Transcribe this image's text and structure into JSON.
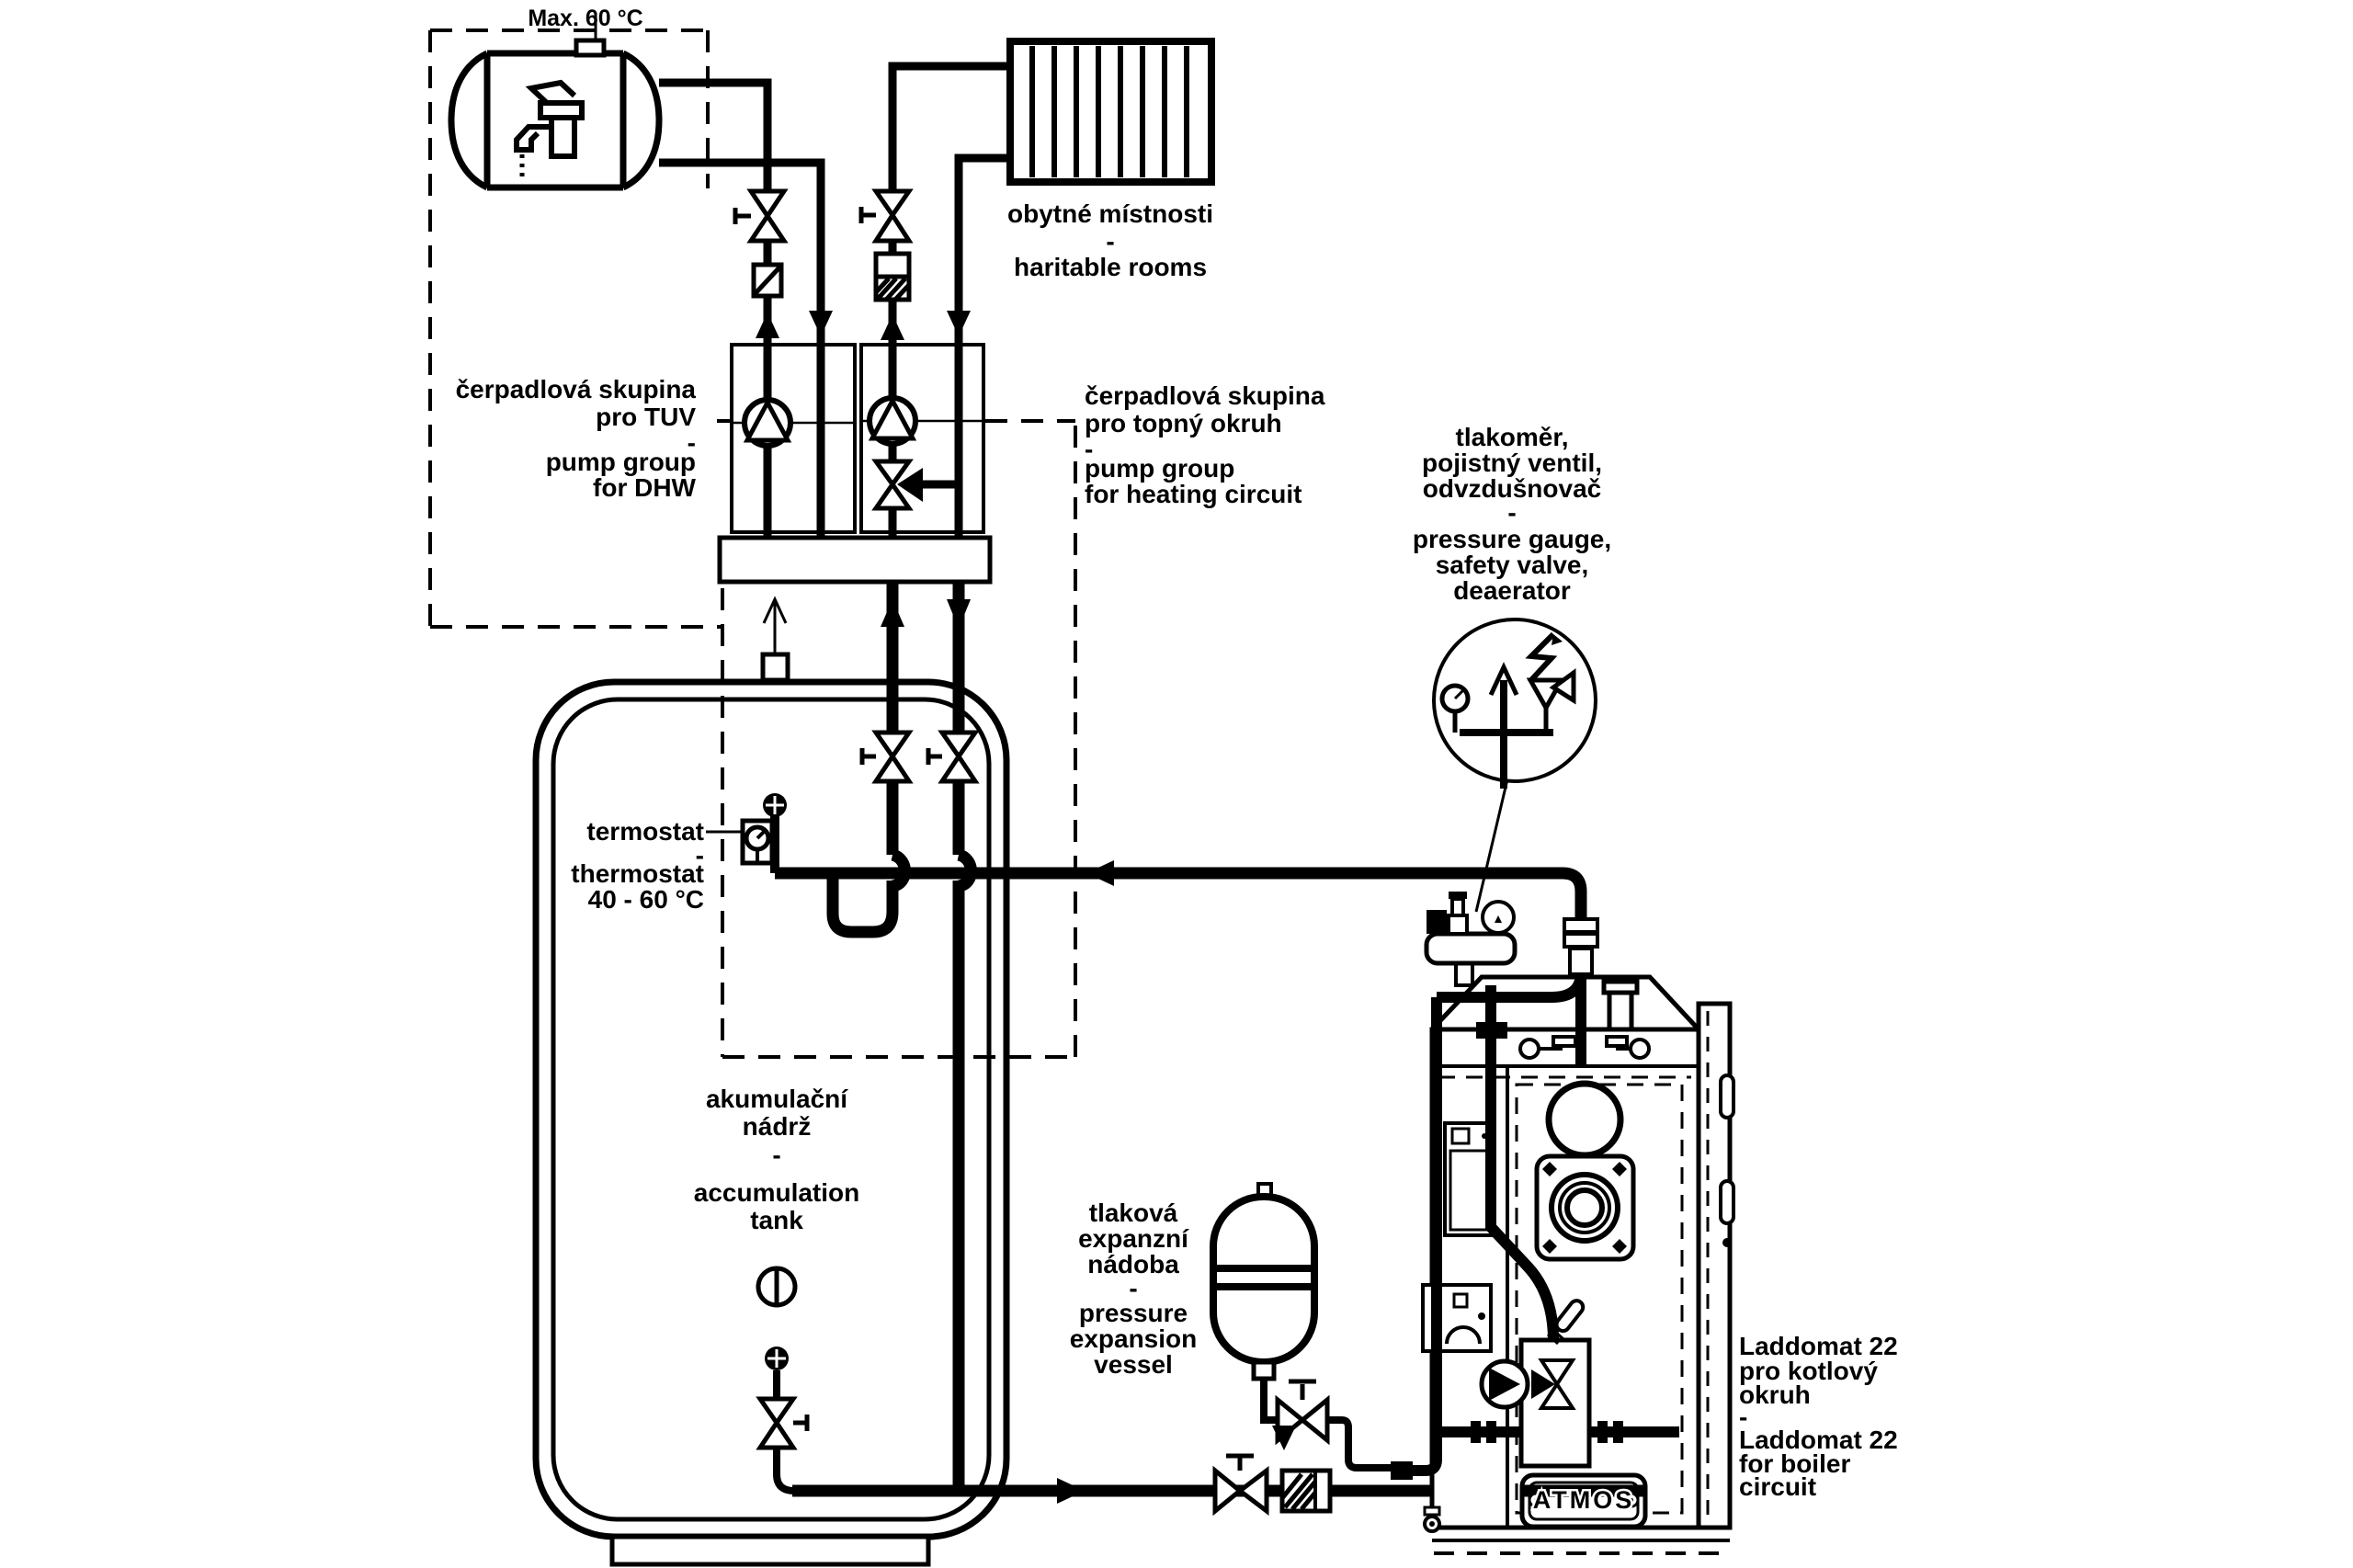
{
  "colors": {
    "line": "#000000",
    "background": "#ffffff"
  },
  "labels": {
    "max_temp": "Max. 60 °C",
    "dhw_pump_group": {
      "lines": [
        "čerpadlová skupina",
        "pro TUV",
        "-",
        "pump group",
        "for DHW"
      ]
    },
    "heating_pump_group": {
      "lines": [
        "čerpadlová skupina",
        "pro topný okruh",
        "-",
        "pump group",
        "for heating circuit"
      ]
    },
    "rooms": {
      "lines": [
        "obytné místnosti",
        "-",
        "haritable rooms"
      ]
    },
    "safety_group": {
      "lines": [
        "tlakoměr,",
        "pojistný ventil,",
        "odvzdušnovač",
        "-",
        "pressure gauge,",
        "safety valve,",
        "deaerator"
      ]
    },
    "thermostat": {
      "lines": [
        "termostat",
        "-",
        "thermostat",
        "40 -  60 °C"
      ]
    },
    "accumulation_tank": {
      "lines": [
        "akumulační",
        "nádrž",
        "-",
        "accumulation",
        "tank"
      ]
    },
    "expansion_vessel": {
      "lines": [
        "tlaková",
        "expanzní",
        "nádoba",
        "-",
        "pressure",
        "expansion",
        "vessel"
      ]
    },
    "laddomat": {
      "lines": [
        "Laddomat 22",
        "pro kotlový",
        "okruh",
        "-",
        "Laddomat 22",
        "for boiler",
        "circuit"
      ]
    },
    "boiler_brand": "ATMOS"
  },
  "components": {
    "pump": "circle-with-triangle",
    "shutoff_valve": "bowtie-valve",
    "three_way_valve": "three-triangle-valve",
    "check_valve": "square-diagonal",
    "filter": "hatched-square",
    "pressure_gauge": "dial-circle",
    "deaerator_vent": "up-arrow",
    "safety_valve": "spring-valve",
    "thermostat_sensor": "dial-in-square",
    "expansion_vessel": "capsule-two-lines",
    "radiator": "finned-rect",
    "dhw_tank": "horizontal-cylinder-faucet",
    "accumulation_tank": "rounded-double-wall-vessel",
    "boiler": "atmos-gasification-boiler",
    "laddomat_unit": "pump-mixing-valve-block"
  }
}
